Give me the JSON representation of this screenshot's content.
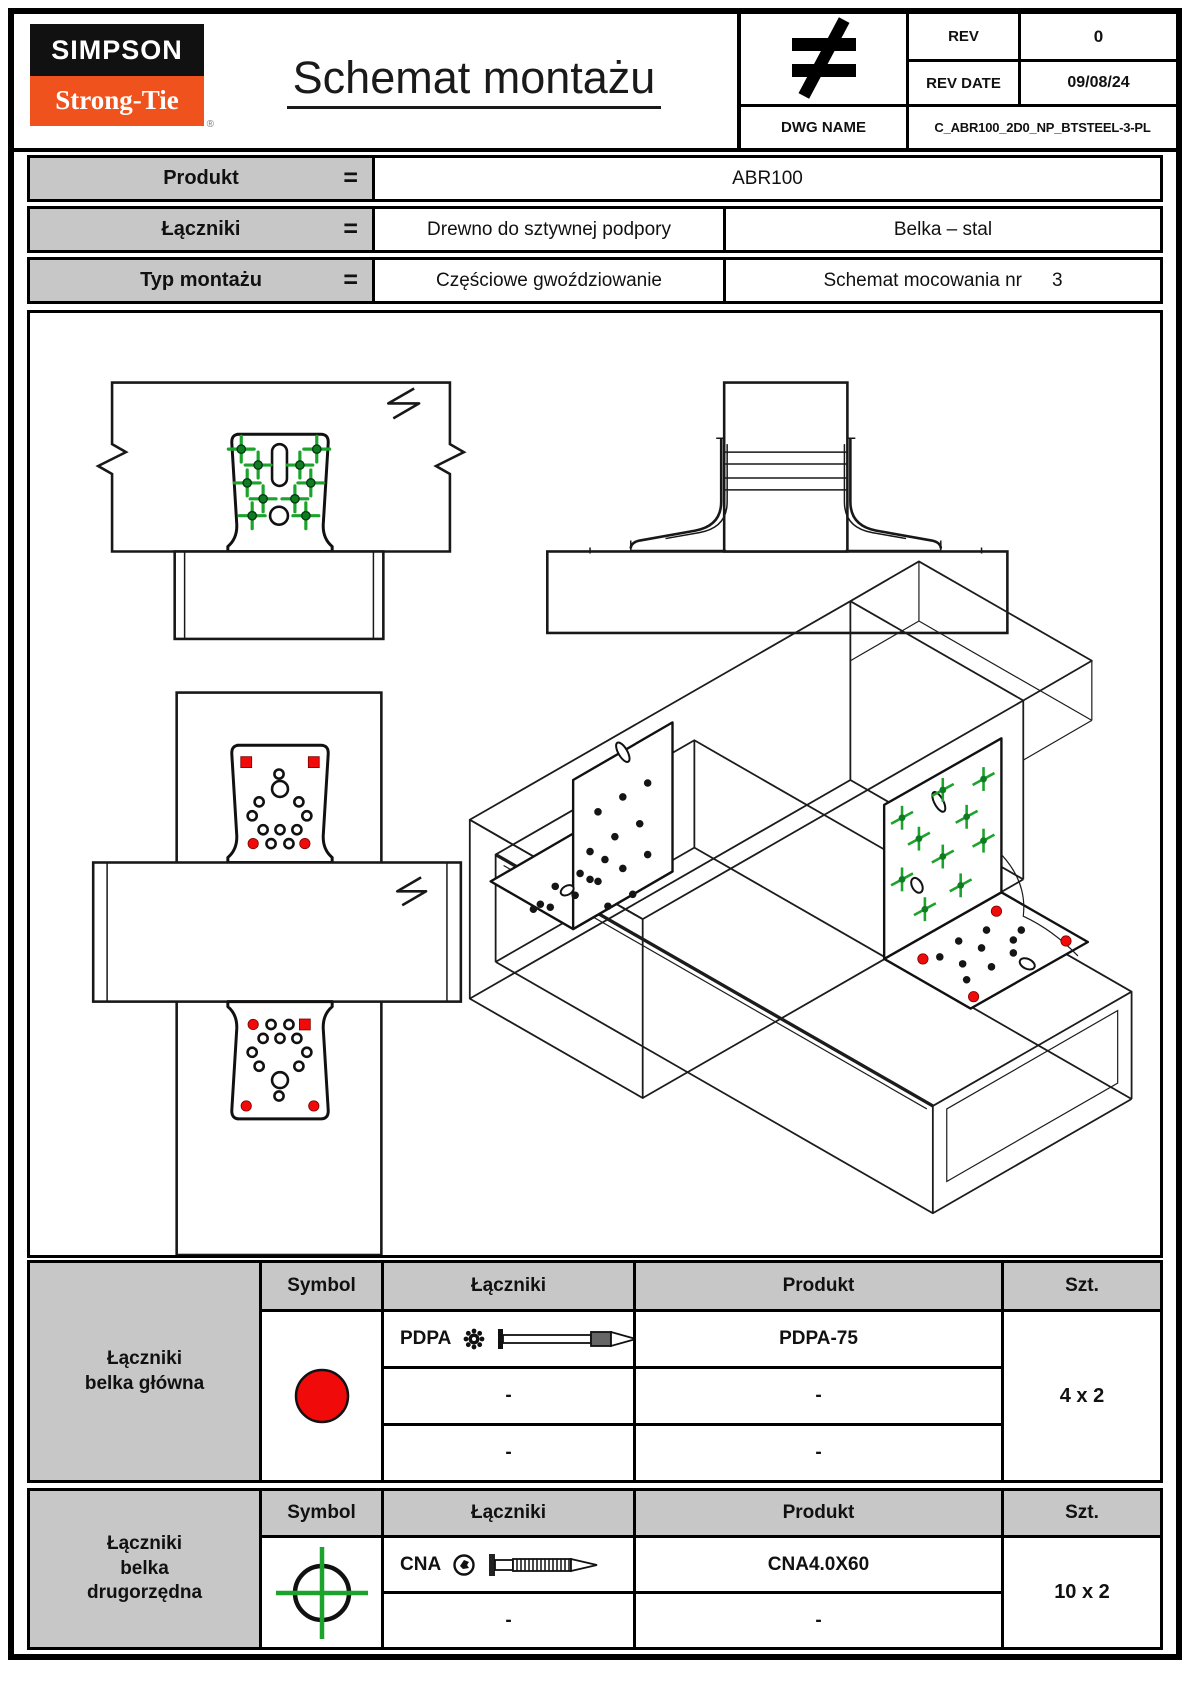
{
  "colors": {
    "brand_orange": "#F0521E",
    "marker_green": "#1CA32C",
    "marker_red": "#F00A0A",
    "header_gray": "#C7C7C7"
  },
  "header": {
    "logo_line1": "SIMPSON",
    "logo_line2": "Strong-Tie",
    "logo_registered": "®",
    "title": "Schemat montażu",
    "stamp_icon": "not-equal",
    "rev_label": "REV",
    "rev_value": "0",
    "rev_date_label": "REV DATE",
    "rev_date_value": "09/08/24",
    "dwg_name_label": "DWG NAME",
    "dwg_name_value": "C_ABR100_2D0_NP_BTSTEEL-3-PL"
  },
  "product_info": {
    "produkt_label": "Produkt",
    "produkt_eq": "=",
    "produkt_value": "ABR100",
    "laczniki_label": "Łączniki",
    "laczniki_eq": "=",
    "laczniki_value_left": "Drewno do sztywnej podpory",
    "laczniki_value_right": "Belka – stal",
    "typ_label": "Typ montażu",
    "typ_eq": "=",
    "typ_value_left": "Częściowe gwoździowanie",
    "typ_value_right_label": "Schemat mocowania nr",
    "typ_value_right_number": "3"
  },
  "fastener_headers": {
    "symbol": "Symbol",
    "fasteners": "Łączniki",
    "product": "Produkt",
    "qty": "Szt."
  },
  "main_beam_table": {
    "group_label": "Łączniki\nbelka główna",
    "symbol_icon": "red-circle",
    "rows": [
      {
        "fastener": "PDPA",
        "product": "PDPA-75"
      },
      {
        "fastener": "-",
        "product": "-"
      },
      {
        "fastener": "-",
        "product": "-"
      }
    ],
    "qty": "4 x 2"
  },
  "secondary_beam_table": {
    "group_label": "Łączniki\nbelka\ndrugorzędna",
    "symbol_icon": "green-crosshair-circle",
    "rows": [
      {
        "fastener": "CNA",
        "product": "CNA4.0X60"
      },
      {
        "fastener": "-",
        "product": "-"
      }
    ],
    "qty": "10 x 2"
  }
}
